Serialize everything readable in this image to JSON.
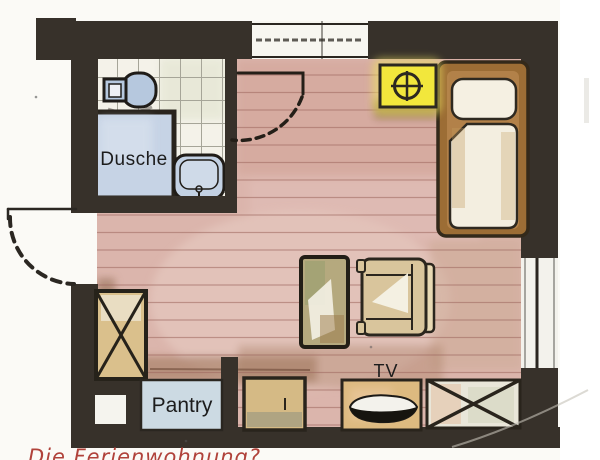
{
  "title": "Die Ferienwohnung?",
  "plan": {
    "labels": {
      "shower": "Dusche",
      "pantry": "Pantry",
      "tv": "TV"
    },
    "rooms": [
      "bathroom",
      "main-room"
    ],
    "furniture": [
      "toilet",
      "sink",
      "shower",
      "bed",
      "table",
      "armchair",
      "wardrobe-left",
      "wardrobe-right",
      "chest",
      "tv-cabinet",
      "pantry-counter"
    ],
    "marker_symbol": "circled-crosshair",
    "doors": [
      "entry-door-left-wall",
      "bathroom-door"
    ],
    "windows": [
      "top-wall-window",
      "right-wall-window"
    ],
    "colors": {
      "wall": "#37312a",
      "floor": "#dbb5ac",
      "tile_floor": "#f4f2e9",
      "water_blue": "#c6d3e5",
      "wood_tan": "#d9bf8b",
      "bed_frame_brown": "#9c6d35",
      "highlight_yellow": "#f2e73c",
      "caption_red": "#b0423a"
    }
  }
}
